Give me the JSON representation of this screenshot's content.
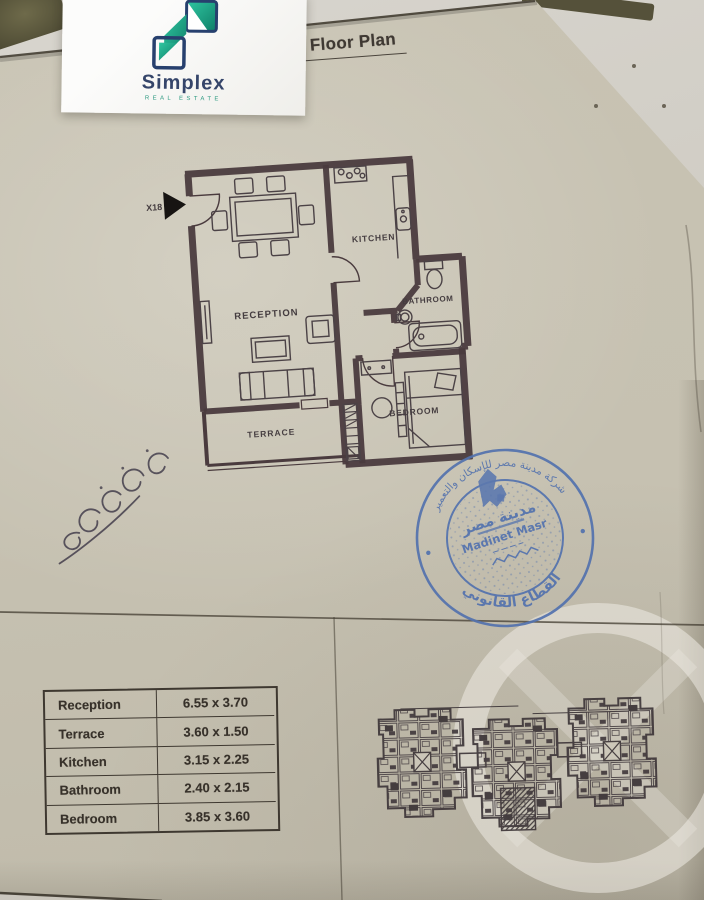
{
  "brand": {
    "name": "Simplex",
    "tagline": "Real Estate"
  },
  "title": "Typical Floor Plan",
  "plan": {
    "unit_label": "X18",
    "labels": {
      "reception": "RECEPTION",
      "kitchen": "KITCHEN",
      "bathroom": "BATHROOM",
      "bedroom": "BEDROOM",
      "terrace": "TERRACE"
    }
  },
  "dimensions_table": {
    "rows": [
      {
        "room": "Reception",
        "size": "6.55 x 3.70"
      },
      {
        "room": "Terrace",
        "size": "3.60 x 1.50"
      },
      {
        "room": "Kitchen",
        "size": "3.15 x 2.25"
      },
      {
        "room": "Bathroom",
        "size": "2.40 x 2.15"
      },
      {
        "room": "Bedroom",
        "size": "3.85 x 3.60"
      }
    ]
  },
  "stamp": {
    "ring_top": "شركة مدينة مصر للإسكان والتعمير",
    "ring_bottom": "القطاع القانوني",
    "center_ar": "مدينة مصر",
    "center_en": "Madinet Masr"
  },
  "colors": {
    "stamp_blue": "#5372ae",
    "wall": "#4a3b3e",
    "logo_teal": "#1fa98b",
    "logo_navy": "#27406e"
  }
}
